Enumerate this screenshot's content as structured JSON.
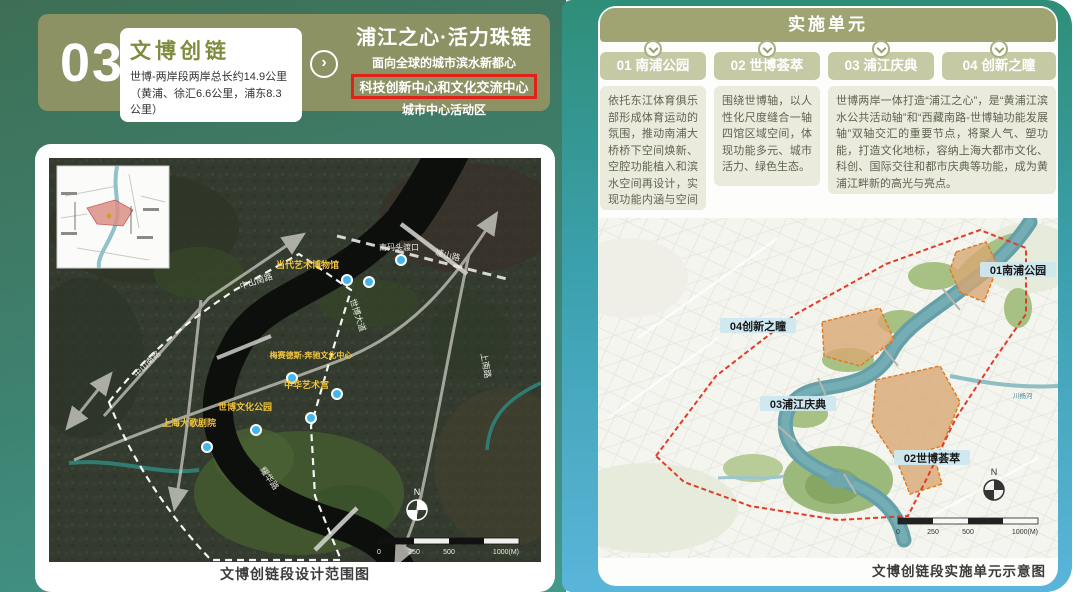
{
  "colors": {
    "left_bg_top": "#3d6f55",
    "left_bg_bottom": "#42998c",
    "right_bg_top": "#2f8e78",
    "right_bg_bottom": "#5ab5da",
    "olive_header": "#8c9263",
    "accent_red": "#e02318",
    "tab_bg": "#c6caa4",
    "box_bg": "#eaebdd",
    "area_chip_bg": "#cde8ef"
  },
  "left": {
    "header": {
      "number": "03",
      "card_title": "文博创链",
      "card_subtitle": "世博-两岸段两岸总长约14.9公里（黄浦、徐汇6.6公里，浦东8.3公里）",
      "slogan": "浦江之心·活力珠链",
      "tagline1": "面向全球的城市滨水新都心",
      "tagline2": "科技创新中心和文化交流中心",
      "tagline3": "城市中心活动区"
    },
    "map": {
      "caption": "文博创链段设计范围图",
      "poi_labels": [
        {
          "label": "当代艺术博物馆"
        },
        {
          "label": "中华艺术宫"
        },
        {
          "label": "梅赛德斯-奔驰文化中心"
        },
        {
          "label": "世博文化公园"
        },
        {
          "label": "上海大歌剧院"
        }
      ],
      "road_labels": [
        {
          "label": "中山南路"
        },
        {
          "label": "中山南路"
        },
        {
          "label": "塘山路"
        },
        {
          "label": "世博大道"
        },
        {
          "label": "耀华路"
        },
        {
          "label": "上南路"
        }
      ],
      "ferry_label": "南码头渡口",
      "compass": "N",
      "scale_ticks": [
        "0",
        "250",
        "500",
        "1000(M)"
      ]
    }
  },
  "right": {
    "header": "实施单元",
    "units": [
      {
        "id": "01",
        "name": "01 南浦公园"
      },
      {
        "id": "02",
        "name": "02 世博荟萃"
      },
      {
        "id": "03",
        "name": "03 浦江庆典"
      },
      {
        "id": "04",
        "name": "04 创新之瞳"
      }
    ],
    "descriptions": [
      {
        "for": "01 南浦公园",
        "text": "依托东江体育俱乐部形成体育运动的氛围，推动南浦大桥桥下空间焕新、空腔功能植入和滨水空间再设计，实现功能内涵与空间品质的全面提升。"
      },
      {
        "for": "02 世博荟萃",
        "text": "围绕世博轴，以人性化尺度缝合一轴四馆区域空间，体现功能多元、城市活力、绿色生态。"
      },
      {
        "for": "03 浦江庆典 / 04 创新之瞳",
        "text": "世博两岸一体打造“浦江之心”，是“黄浦江滨水公共活动轴”和“西藏南路-世博轴功能发展轴”双轴交汇的重要节点，将聚人气、塑功能，打造文化地标，容纳上海大都市文化、科创、国际交往和都市庆典等功能，成为黄浦江畔新的高光与亮点。"
      }
    ],
    "map": {
      "caption": "文博创链段实施单元示意图",
      "area_labels": [
        {
          "label": "01南浦公园"
        },
        {
          "label": "04创新之瞳"
        },
        {
          "label": "03浦江庆典"
        },
        {
          "label": "02世博荟萃"
        }
      ],
      "water_label": "川杨河",
      "compass": "N",
      "scale_ticks": [
        "0",
        "250",
        "500",
        "1000(M)"
      ]
    }
  }
}
